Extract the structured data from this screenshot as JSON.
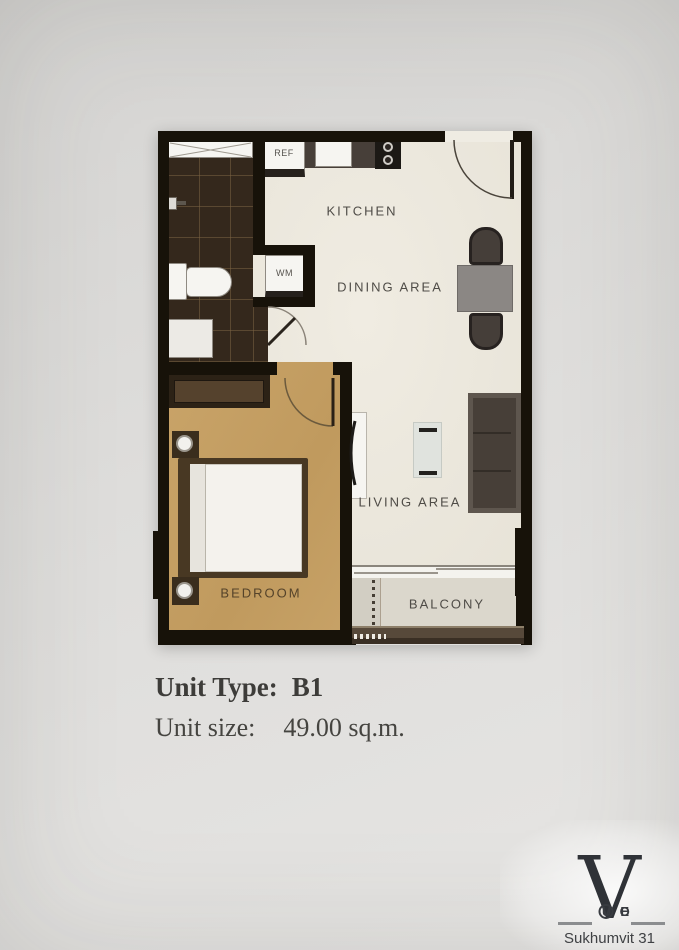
{
  "floor_plan": {
    "rooms": [
      {
        "id": "kitchen",
        "label": "KITCHEN"
      },
      {
        "id": "dining",
        "label": "DINING AREA"
      },
      {
        "id": "living",
        "label": "LIVING AREA"
      },
      {
        "id": "bedroom",
        "label": "BEDROOM"
      },
      {
        "id": "balcony",
        "label": "BALCONY"
      }
    ],
    "fixtures": [
      {
        "id": "refrigerator",
        "label": "REF"
      },
      {
        "id": "washing-machine",
        "label": "WM"
      }
    ]
  },
  "unit_info": {
    "type_label": "Unit Type:",
    "type_value": "B1",
    "size_label": "Unit size:",
    "size_value": "49.00 sq.m."
  },
  "branding": {
    "logo_letter": "V",
    "logo_name": "VOGUE",
    "logo_name_left": "VO",
    "logo_name_right": "UE",
    "location": "Sukhumvit 31"
  },
  "colors": {
    "walls": "#171209",
    "floor": "#ebe7dd",
    "bedroom_floor": "#c3a067",
    "bath_tile": "#34281c",
    "kitchen_counter": "#473f39",
    "sofa": "#554e47",
    "dining_table": "#8b8784",
    "balcony_floor": "#dbd7cc",
    "label_text": "#4f4c47",
    "logo": "#2f3237"
  }
}
